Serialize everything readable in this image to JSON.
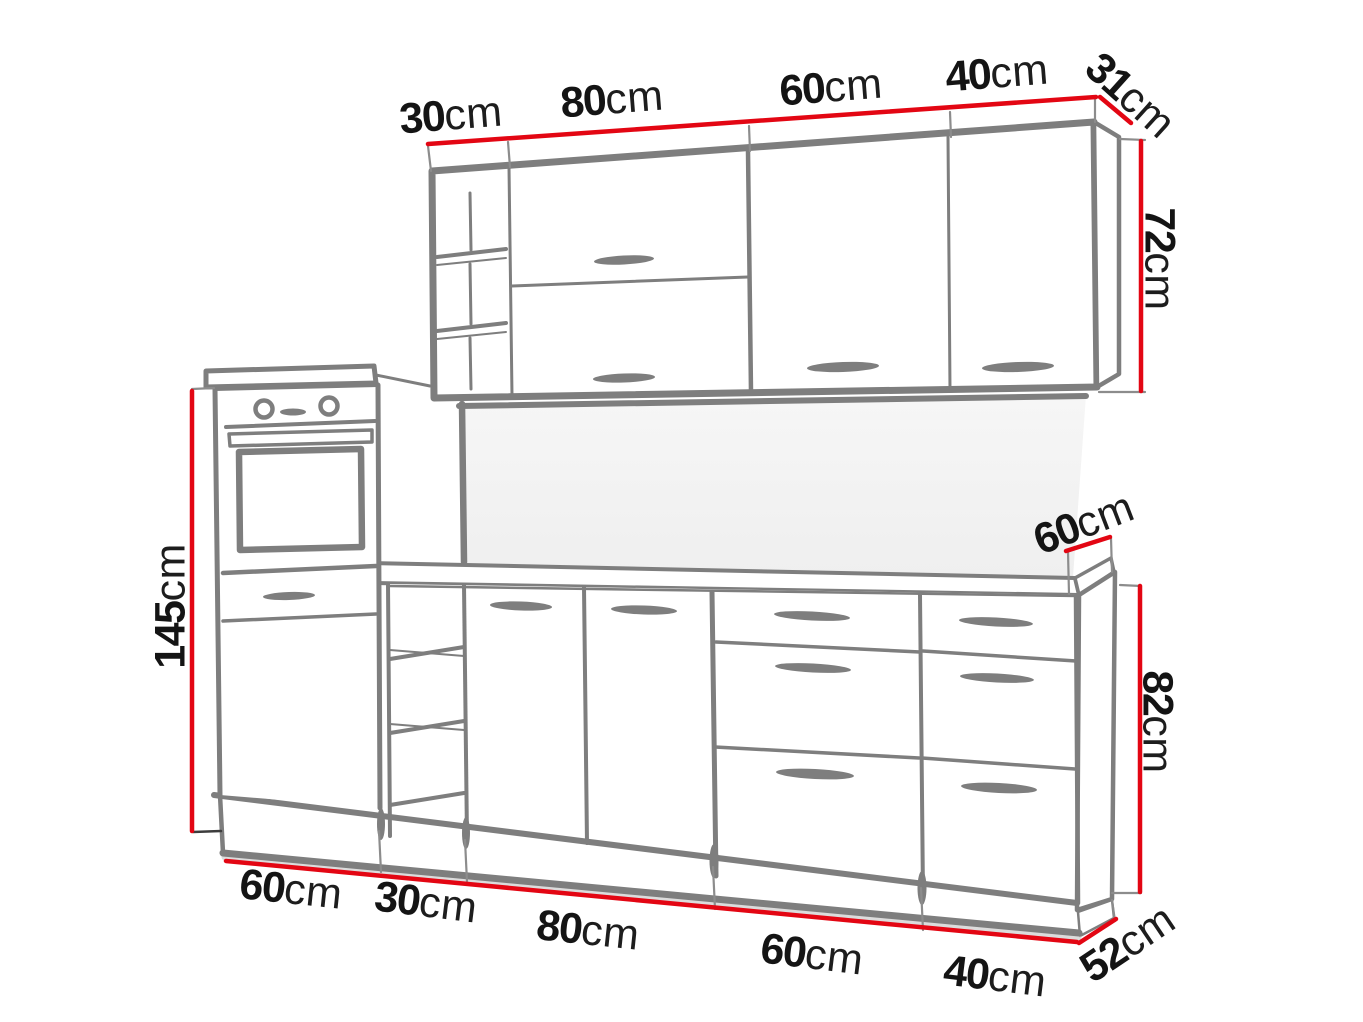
{
  "page": {
    "title": "Kitchen furniture set — dimension line drawing",
    "background": "#ffffff",
    "drawing_style": "hand-drawn gray outline sketch with red dimension lines"
  },
  "colors": {
    "sketch_line": "#7e7e7e",
    "dimension_line": "#e30613",
    "label_text": "#141414",
    "tick_line": "#8c8c8c",
    "backsplash_fill": "#f3f3f3"
  },
  "labels": {
    "wall_units": {
      "widths": [
        {
          "value": "30",
          "unit": "cm"
        },
        {
          "value": "80",
          "unit": "cm"
        },
        {
          "value": "60",
          "unit": "cm"
        },
        {
          "value": "40",
          "unit": "cm"
        }
      ],
      "depth": {
        "value": "31",
        "unit": "cm"
      },
      "height": {
        "value": "72",
        "unit": "cm"
      }
    },
    "tall_unit": {
      "height": {
        "value": "145",
        "unit": "cm"
      }
    },
    "base_units": {
      "widths": [
        {
          "value": "60",
          "unit": "cm"
        },
        {
          "value": "30",
          "unit": "cm"
        },
        {
          "value": "80",
          "unit": "cm"
        },
        {
          "value": "60",
          "unit": "cm"
        },
        {
          "value": "40",
          "unit": "cm"
        }
      ],
      "worktop_depth": {
        "value": "60",
        "unit": "cm"
      },
      "height": {
        "value": "82",
        "unit": "cm"
      },
      "depth": {
        "value": "52",
        "unit": "cm"
      }
    }
  }
}
